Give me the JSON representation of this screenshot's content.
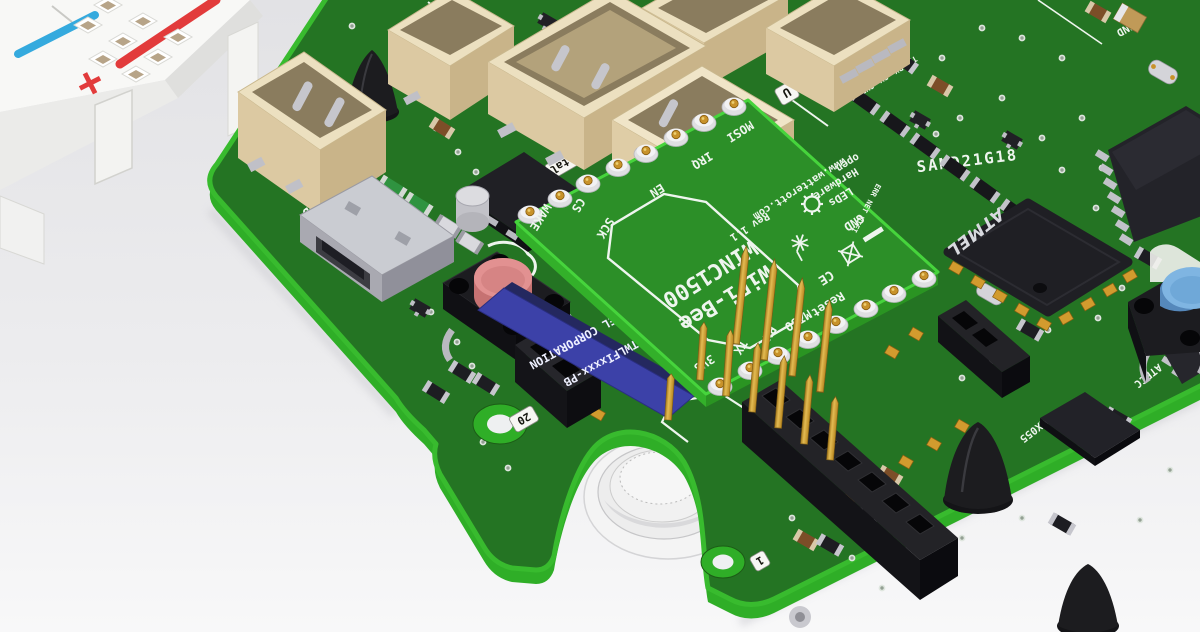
{
  "module": {
    "title_line1": "WiFi-Bee",
    "title_line2": "WINC1500",
    "rev": "Rev 1.1",
    "url": "www.watterott.com",
    "oshw_line1": "open",
    "oshw_line2": "Hardware",
    "ce_mark": "CE",
    "pins_top": [
      "WAKE",
      "CS",
      "SCK",
      "EN",
      "IRQ",
      "MOSI"
    ],
    "pins_bottom": [
      "3V3",
      "TX",
      "RX",
      "MISO",
      "Reset"
    ],
    "gnd_pin": "GND",
    "leds_label": "LEDs",
    "leds_channels": "ERR NET WIFI"
  },
  "winc_chip": {
    "line1": "ATMEL CORPORATION",
    "line2": "ATWLFIxxxx-PB"
  },
  "board": {
    "mcu_silk": "SAMD21G18",
    "mcu_logo": "ATMEL",
    "imu_silk": "BMX055",
    "crypto_silk": "ATECC",
    "gnd_silk_top": "GND",
    "power_5v": "5V",
    "power_gnd": "GND",
    "uart_labels": [
      "GND",
      "5V",
      "RX",
      "TX"
    ],
    "tag_c": "C",
    "tag_b": "B",
    "tag_xtal": "tal",
    "tag_2": "2",
    "tag_a": "a",
    "tag_u": "U",
    "tag_1": "1",
    "tag_20": "20",
    "tag_1_bottom": "1"
  },
  "breadboard": {
    "plus_mark": "+",
    "minus_mark": "-"
  },
  "icons": {
    "gear": "open-hardware-gear",
    "antenna": "pcb-antenna",
    "weee": "weee-crossed-bin"
  },
  "colors": {
    "pcb_top": "#247423",
    "pcb_edge": "#38bb2e",
    "module_top": "#2c8f28",
    "silk": "#eef5ee",
    "winc_blue": "#3c41a8",
    "gold": "#c8922a",
    "connector_cream": "#ece0c0",
    "button_red": "#dd8787",
    "button_blue": "#6fa8d8"
  }
}
